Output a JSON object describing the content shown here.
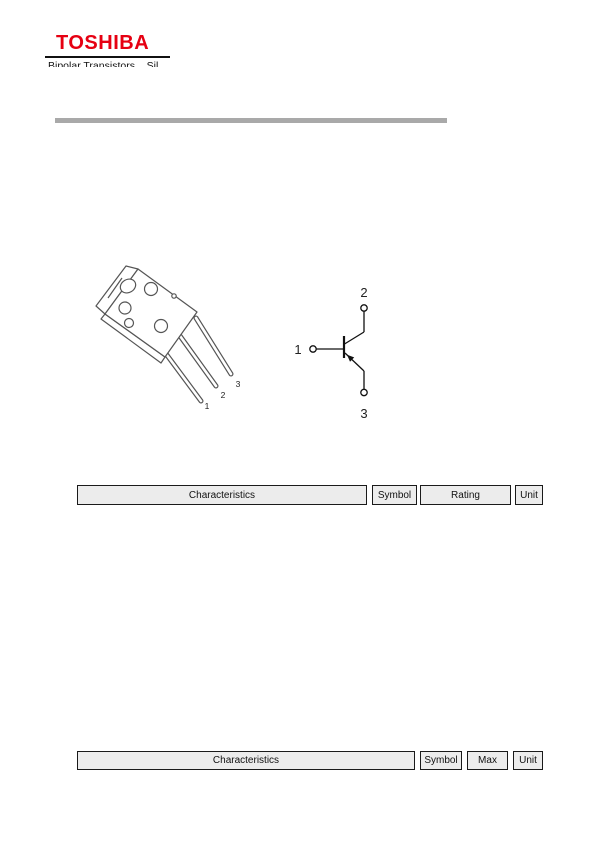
{
  "logo": {
    "brand": "TOSHIBA",
    "brand_color": "#e60012",
    "subtitle_clipped": "Bipolar Transistors    Sil"
  },
  "divider": {
    "color": "#a9a9a9"
  },
  "package_figure": {
    "description": "transistor-package-line-drawing",
    "pin_labels": [
      "1",
      "2",
      "3"
    ]
  },
  "symbol_figure": {
    "description": "transistor-circuit-symbol",
    "base_label": "1",
    "collector_label": "2",
    "emitter_label": "3"
  },
  "ratings_table_header": {
    "columns": [
      "Characteristics",
      "Symbol",
      "Rating",
      "Unit"
    ]
  },
  "electrical_table_header": {
    "columns": [
      "Characteristics",
      "Symbol",
      "Max",
      "Unit"
    ]
  },
  "colors": {
    "header_cell_bg": "#ececec",
    "header_cell_border": "#1a1a1a"
  }
}
